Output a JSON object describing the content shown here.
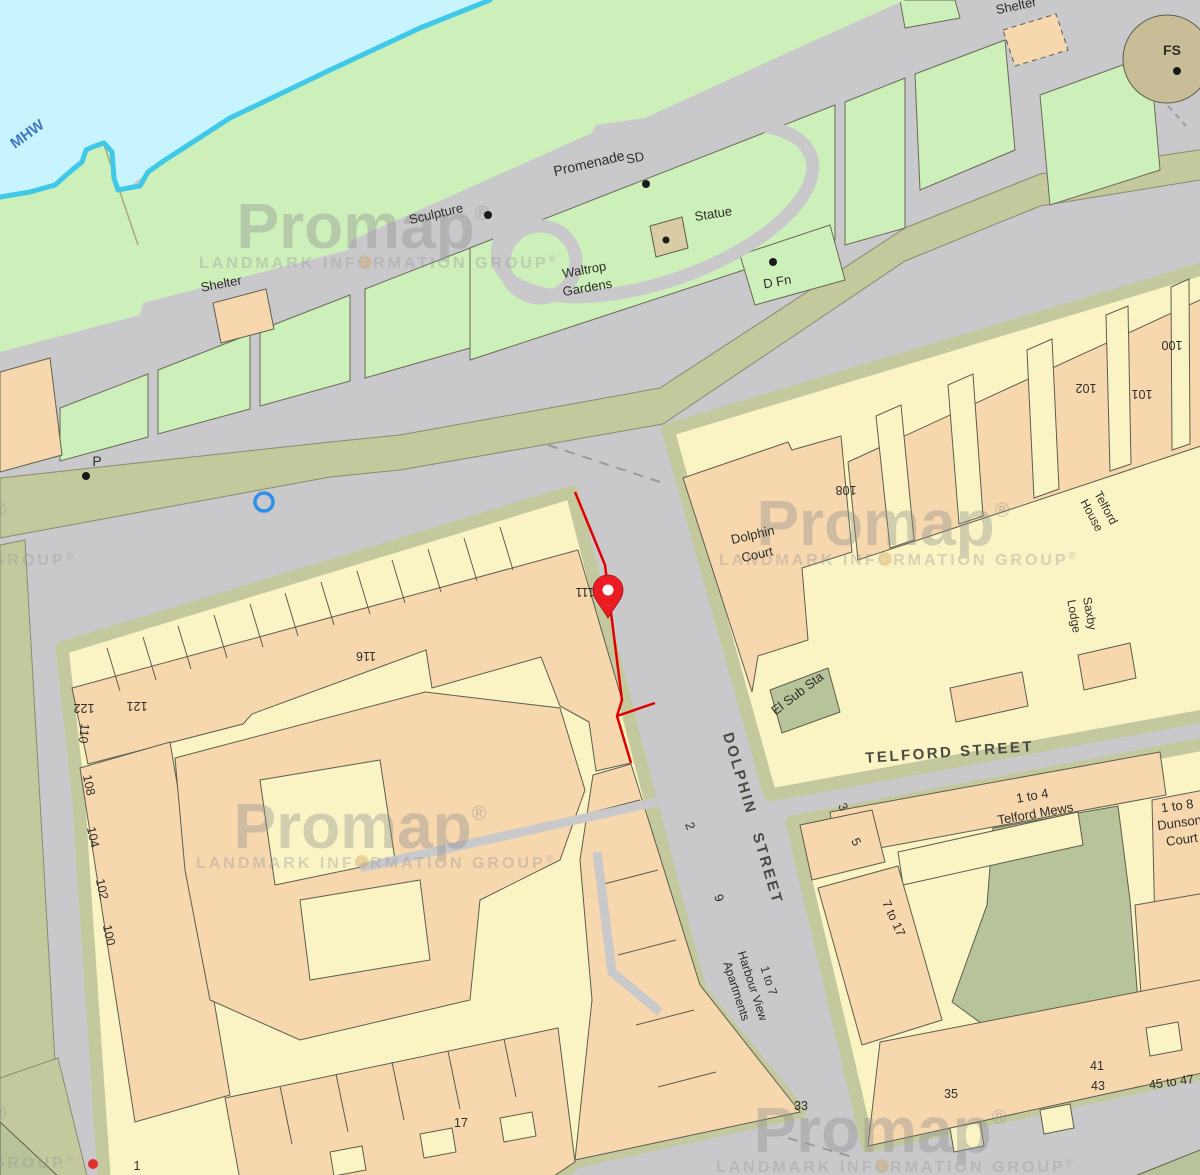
{
  "map": {
    "watermark": {
      "brand": "Promap",
      "reg": "®",
      "tagline": "LANDMARK INFORMATION GROUP",
      "tagline_reg": "®"
    },
    "water_label": "MHW",
    "streets": {
      "promenade": "Promenade",
      "dolphin_word1": "DOLPHIN",
      "dolphin_word2": "STREET",
      "telford": "TELFORD STREET"
    },
    "features": {
      "shelter_west": "Shelter",
      "shelter_ne": "Shelter",
      "sculpture": "Sculpture",
      "sd": "SD",
      "statue": "Statue",
      "dfn": "D Fn",
      "fs": "FS",
      "p": "P",
      "waltrop_line1": "Waltrop",
      "waltrop_line2": "Gardens",
      "el_sub_sta": "El Sub Sta"
    },
    "buildings": {
      "dolphin_court_line1": "Dolphin",
      "dolphin_court_line2": "Court",
      "telford_house_line1": "Telford",
      "telford_house_line2": "House",
      "saxby_line1": "Saxby",
      "saxby_line2": "Lodge",
      "telford_mews_line1": "1 to 4",
      "telford_mews_line2": "Telford Mews",
      "dunson_line1": "1 to 8",
      "dunson_line2": "Dunson",
      "dunson_line3": "Court",
      "harbour_line1": "1 to 7",
      "harbour_line2": "Harbour View",
      "harbour_line3": "Apartments",
      "seven_to_17": "7 to 17",
      "fortyfive_to_47": "45 to 47"
    },
    "house_numbers": {
      "n122": "122",
      "n121": "121",
      "n110": "110",
      "n116": "116",
      "n111": "111",
      "n108w": "108",
      "n104w": "104",
      "n102w": "102",
      "n100w": "100",
      "n1": "1",
      "n17": "17",
      "n2": "2",
      "n9": "9",
      "n33": "33",
      "n3": "3",
      "n5": "5",
      "n35": "35",
      "n41": "41",
      "n43": "43",
      "n108e": "108",
      "n102e": "102",
      "n101": "101",
      "n100e": "100"
    },
    "colors": {
      "road": "#C9C9CB",
      "building_yellow": "#FAF4C4",
      "building_peach": "#F6D7AE",
      "water": "#C7F4FE",
      "shoreline": "#3FC8E8",
      "grass": "#CDEFB9",
      "sidewalk_khaki": "#C4C89D",
      "courtyard": "#B7C399",
      "plot_boundary_red": "#E00000",
      "pin_red": "#ED1C24",
      "marker_blue": "#2F8FE8",
      "watermark_gray": "#8F8F8F",
      "watermark_dot_orange": "#E8A13C"
    }
  }
}
